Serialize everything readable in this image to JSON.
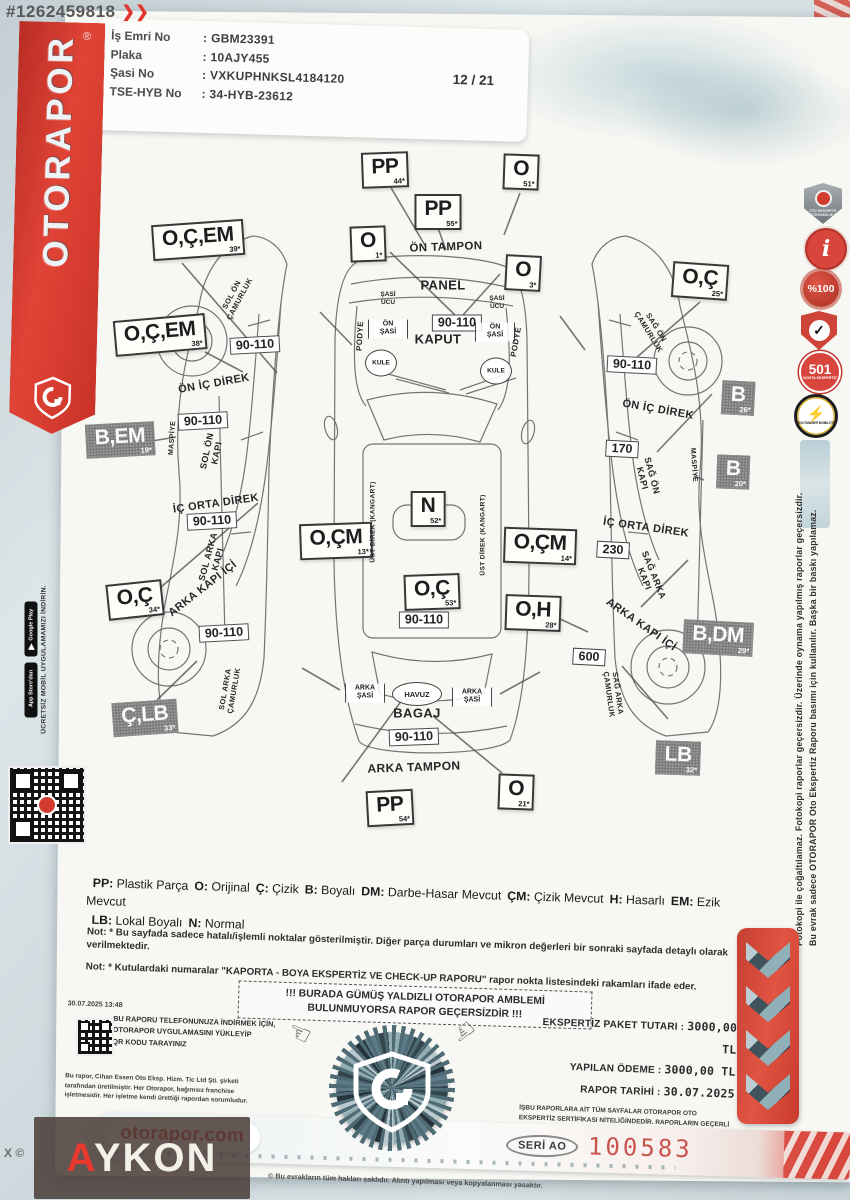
{
  "watermark": {
    "listing_id": "#1262459818",
    "chevrons": "❯❯",
    "brand_a": "A",
    "brand_rest": "YKON",
    "corner": "X ©"
  },
  "ribbon": {
    "brand": "OTORAPOR",
    "reg": "®"
  },
  "header": {
    "fields": [
      {
        "label": "İş Emri No",
        "value": "GBM23391"
      },
      {
        "label": "Plaka",
        "value": "10AJY455"
      },
      {
        "label": "Şasi No",
        "value": "VXKUPHNKSL4184120"
      },
      {
        "label": "TSE-HYB No",
        "value": "34-HYB-23612"
      }
    ],
    "page": "12 / 21"
  },
  "badges": [
    {
      "name": "mucit-shield-badge",
      "label": "OTO EKSPERTİZ SEKTÖRÜNÜN MUCİDİ"
    },
    {
      "name": "info-badge",
      "label": "i"
    },
    {
      "name": "percent-100-badge",
      "label": "%100"
    },
    {
      "name": "check-shield-badge",
      "label": "✓"
    },
    {
      "name": "501-nokta-badge",
      "label": "501",
      "sub": "NOKTA EKSPERTİZ"
    },
    {
      "name": "voltmaner-badge",
      "label": "⚡",
      "sub": "VOLTMANER MOBILITY"
    }
  ],
  "side_disclaimer": {
    "line1": "Bu evrak sadece OTORAPOR Oto Ekspertiz Raporu basımı için kullanılır. Başka bir baskı yapılamaz.",
    "line2": "Fotokopi ile çoğaltılamaz. Fotokopi raporlar geçersizdir. Üzerinde oynama yapılmış raporlar geçersizdir."
  },
  "diagram": {
    "markers": [
      {
        "k": "light",
        "t": "O,Ç,EM",
        "n": "39*",
        "x": 198,
        "y": 240,
        "rot": -4
      },
      {
        "k": "light",
        "t": "O,Ç,EM",
        "n": "38*",
        "x": 160,
        "y": 335,
        "rot": -5
      },
      {
        "k": "light",
        "t": "O,Ç",
        "n": "34*",
        "x": 135,
        "y": 600,
        "rot": -6
      },
      {
        "k": "light",
        "t": "PP",
        "n": "44*",
        "x": 385,
        "y": 170,
        "rot": -2
      },
      {
        "k": "light",
        "t": "PP",
        "n": "55*",
        "x": 438,
        "y": 212,
        "rot": 0
      },
      {
        "k": "light",
        "t": "O",
        "n": "51*",
        "x": 521,
        "y": 172,
        "rot": 2
      },
      {
        "k": "light",
        "t": "O",
        "n": "1*",
        "x": 368,
        "y": 244,
        "rot": -2
      },
      {
        "k": "light",
        "t": "O",
        "n": "3*",
        "x": 523,
        "y": 273,
        "rot": 3
      },
      {
        "k": "light",
        "t": "O,Ç",
        "n": "25*",
        "x": 700,
        "y": 281,
        "rot": 4
      },
      {
        "k": "light",
        "t": "N",
        "n": "52*",
        "x": 428,
        "y": 509,
        "rot": 0
      },
      {
        "k": "light",
        "t": "O,ÇM",
        "n": "13*",
        "x": 336,
        "y": 541,
        "rot": -2
      },
      {
        "k": "light",
        "t": "O,ÇM",
        "n": "14*",
        "x": 540,
        "y": 546,
        "rot": 2
      },
      {
        "k": "light",
        "t": "O,Ç",
        "n": "53*",
        "x": 432,
        "y": 592,
        "rot": -2
      },
      {
        "k": "light",
        "t": "O,H",
        "n": "28*",
        "x": 533,
        "y": 613,
        "rot": 2
      },
      {
        "k": "light",
        "t": "PP",
        "n": "54*",
        "x": 390,
        "y": 808,
        "rot": -3
      },
      {
        "k": "light",
        "t": "O",
        "n": "21*",
        "x": 516,
        "y": 792,
        "rot": 2
      },
      {
        "k": "dark",
        "t": "B,EM",
        "n": "19*",
        "x": 120,
        "y": 440,
        "rot": -3
      },
      {
        "k": "dark",
        "t": "Ç,LB",
        "n": "33*",
        "x": 145,
        "y": 718,
        "rot": -4
      },
      {
        "k": "dark",
        "t": "B",
        "n": "26*",
        "x": 738,
        "y": 398,
        "rot": 3
      },
      {
        "k": "dark",
        "t": "B",
        "n": "20*",
        "x": 733,
        "y": 472,
        "rot": 2
      },
      {
        "k": "dark",
        "t": "B,DM",
        "n": "29*",
        "x": 718,
        "y": 638,
        "rot": 3
      },
      {
        "k": "dark",
        "t": "LB",
        "n": "32*",
        "x": 678,
        "y": 758,
        "rot": 2
      },
      {
        "k": "val",
        "t": "90-110",
        "x": 255,
        "y": 345,
        "rot": -3
      },
      {
        "k": "val",
        "t": "90-110",
        "x": 203,
        "y": 421,
        "rot": -3
      },
      {
        "k": "val",
        "t": "90-110",
        "x": 212,
        "y": 521,
        "rot": -3
      },
      {
        "k": "val",
        "t": "90-110",
        "x": 224,
        "y": 633,
        "rot": -3
      },
      {
        "k": "val",
        "t": "90-110",
        "x": 457,
        "y": 323,
        "rot": 0
      },
      {
        "k": "val",
        "t": "90-110",
        "x": 424,
        "y": 620,
        "rot": 0
      },
      {
        "k": "val",
        "t": "90-110",
        "x": 414,
        "y": 737,
        "rot": -2
      },
      {
        "k": "val",
        "t": "90-110",
        "x": 632,
        "y": 365,
        "rot": 3
      },
      {
        "k": "val",
        "t": "170",
        "x": 622,
        "y": 449,
        "rot": 3
      },
      {
        "k": "val",
        "t": "230",
        "x": 613,
        "y": 550,
        "rot": 3
      },
      {
        "k": "val",
        "t": "600",
        "x": 589,
        "y": 657,
        "rot": 3
      },
      {
        "k": "sbox",
        "t": "ÖN|ŞASİ",
        "x": 388,
        "y": 329
      },
      {
        "k": "sbox",
        "t": "ÖN|ŞASİ",
        "x": 495,
        "y": 332
      },
      {
        "k": "sbox",
        "t": "ARKA|ŞASİ",
        "x": 365,
        "y": 693
      },
      {
        "k": "sbox",
        "t": "ARKA|ŞASİ",
        "x": 472,
        "y": 697
      },
      {
        "k": "txt",
        "t": "ŞASİ|UCU",
        "x": 388,
        "y": 299
      },
      {
        "k": "txt",
        "t": "ŞASİ|UCU",
        "x": 497,
        "y": 303
      },
      {
        "k": "circ",
        "t": "KULE",
        "x": 381,
        "y": 363
      },
      {
        "k": "circ",
        "t": "KULE",
        "x": 496,
        "y": 371
      },
      {
        "k": "ell",
        "t": "HAVUZ",
        "x": 417,
        "y": 694
      },
      {
        "k": "part",
        "t": "ÖN TAMPON",
        "x": 446,
        "y": 248,
        "rot": -2,
        "fs": 11.5
      },
      {
        "k": "part",
        "t": "PANEL",
        "x": 443,
        "y": 286,
        "rot": 0,
        "fs": 13
      },
      {
        "k": "part",
        "t": "KAPUT",
        "x": 438,
        "y": 340,
        "rot": 0,
        "fs": 13
      },
      {
        "k": "part",
        "t": "BAGAJ",
        "x": 417,
        "y": 714,
        "rot": 0,
        "fs": 13
      },
      {
        "k": "part",
        "t": "ARKA TAMPON",
        "x": 414,
        "y": 768,
        "rot": -2,
        "fs": 12
      },
      {
        "k": "part",
        "t": "ÖN İÇ DİREK",
        "x": 214,
        "y": 384,
        "rot": -10,
        "fs": 11
      },
      {
        "k": "part",
        "t": "İÇ ORTA DİREK",
        "x": 216,
        "y": 504,
        "rot": -8,
        "fs": 11
      },
      {
        "k": "part",
        "t": "ARKA KAPI İÇİ",
        "x": 203,
        "y": 589,
        "rot": -38,
        "fs": 11
      },
      {
        "k": "part",
        "t": "SOL ÖN|KAPI",
        "x": 212,
        "y": 452,
        "rot": -78,
        "fs": 9
      },
      {
        "k": "part",
        "t": "SOL ARKA|KAPI",
        "x": 213,
        "y": 558,
        "rot": -75,
        "fs": 9
      },
      {
        "k": "part",
        "t": "SOL ÖN|ÇAMURLUK",
        "x": 236,
        "y": 297,
        "rot": -62,
        "fs": 7.5
      },
      {
        "k": "part",
        "t": "SOL ARKA|ÇAMURLUK",
        "x": 230,
        "y": 690,
        "rot": -80,
        "fs": 7.5
      },
      {
        "k": "part",
        "t": "MASPİYE",
        "x": 173,
        "y": 438,
        "rot": -86,
        "fs": 7
      },
      {
        "k": "part",
        "t": "PODYE",
        "x": 360,
        "y": 336,
        "rot": -87,
        "fs": 8
      },
      {
        "k": "part",
        "t": "PODYE",
        "x": 516,
        "y": 342,
        "rot": -80,
        "fs": 8
      },
      {
        "k": "part",
        "t": "ÜST DİREK (KANGART)",
        "x": 373,
        "y": 522,
        "rot": -90,
        "fs": 6.5
      },
      {
        "k": "part",
        "t": "ÜST DİREK (KANGART)",
        "x": 483,
        "y": 535,
        "rot": -90,
        "fs": 6.5
      },
      {
        "k": "part",
        "t": "SAĞ ÖN|ÇAMURLUK",
        "x": 652,
        "y": 330,
        "rot": 58,
        "fs": 7.5
      },
      {
        "k": "part",
        "t": "ÖN İÇ DİREK",
        "x": 658,
        "y": 410,
        "rot": 10,
        "fs": 11
      },
      {
        "k": "part",
        "t": "SAĞ ÖN|KAPI",
        "x": 647,
        "y": 477,
        "rot": 75,
        "fs": 9
      },
      {
        "k": "part",
        "t": "MASPİYE",
        "x": 693,
        "y": 465,
        "rot": 86,
        "fs": 7
      },
      {
        "k": "part",
        "t": "İÇ ORTA DİREK",
        "x": 646,
        "y": 528,
        "rot": 8,
        "fs": 11
      },
      {
        "k": "part",
        "t": "SAĞ ARKA|KAPI",
        "x": 649,
        "y": 577,
        "rot": 68,
        "fs": 9
      },
      {
        "k": "part",
        "t": "ARKA KAPI İÇİ",
        "x": 641,
        "y": 625,
        "rot": 35,
        "fs": 11
      },
      {
        "k": "part",
        "t": "SAĞ ARKA|ÇAMURLUK",
        "x": 613,
        "y": 694,
        "rot": 82,
        "fs": 7.5
      }
    ]
  },
  "legend": {
    "items": [
      {
        "k": "PP",
        "v": "Plastik Parça"
      },
      {
        "k": "O",
        "v": "Orijinal"
      },
      {
        "k": "Ç",
        "v": "Çizik"
      },
      {
        "k": "B",
        "v": "Boyalı"
      },
      {
        "k": "DM",
        "v": "Darbe-Hasar Mevcut"
      },
      {
        "k": "ÇM",
        "v": "Çizik Mevcut"
      },
      {
        "k": "H",
        "v": "Hasarlı"
      },
      {
        "k": "EM",
        "v": "Ezik Mevcut"
      },
      {
        "k": "LB",
        "v": "Lokal Boyalı"
      },
      {
        "k": "N",
        "v": "Normal"
      }
    ]
  },
  "notes": [
    "Not: * Bu sayfada sadece hatalı/işlemli noktalar gösterilmiştir. Diğer parça durumları ve mikron değerleri bir sonraki sayfada detaylı olarak verilmektedir.",
    "Not: * Kutulardaki numaralar \"KAPORTA - BOYA EKSPERTİZ VE CHECK-UP RAPORU\" rapor nokta listesindeki rakamları ifade eder."
  ],
  "warning": {
    "line1": "!!! BURADA GÜMÜŞ YALDIZLI OTORAPOR AMBLEMİ",
    "line2": "BULUNMUYORSA RAPOR GEÇERSİZDİR !!!"
  },
  "app_promo": {
    "caption": "ÜCRETSİZ MOBİL UYGULAMAMIZI İNDİRİN.",
    "stores": [
      {
        "name": "app-store-badge",
        "label": "App Store'dan"
      },
      {
        "name": "google-play-badge",
        "label": "Google Play"
      }
    ]
  },
  "download": {
    "timestamp": "30.07.2025 13:48",
    "lines": [
      "BU RAPORU TELEFONUNUZA İNDİRMEK İÇİN,",
      "OTORAPOR UYGULAMASINI YÜKLEYİP",
      "QR KODU TARAYINIZ"
    ],
    "producer": "Bu rapor, Cihan Essen Oto Eksp. Hizm. Tic Ltd Şti. şirketi tarafından üretilmiştir. Her Otorapor, bağımsız franchise işletmesidir. Her işletme kendi ürettiği rapordan sorumludur."
  },
  "payment": {
    "rows": [
      {
        "label": "EKSPERTİZ PAKET TUTARI",
        "value": "3000,00 TL"
      },
      {
        "label": "YAPILAN ÖDEME",
        "value": "3000,00 TL"
      },
      {
        "label": "RAPOR TARİHİ",
        "value": "30.07.2025"
      }
    ],
    "hologram_note": "İŞBU RAPORLARA AİT TÜM SAYFALAR OTORAPOR OTO EKSPERTİZ SERTİFİKASI NİTELİĞİNDEDİR. RAPORLARIN GEÇERLİ OLABİLMESİ İÇİN HER SAYFADA GÜMÜŞ HOLOGRAM BULUNMAK ZORUNDADIR. GÜMÜŞ HOLOGRAM BULUNMAYAN, ANTETLİ KAĞIDA BASILMAMIŞ RAPORLAR GEÇERSİZDİR."
  },
  "footer": {
    "site": "otorapor.com",
    "serial_label": "SERİ AO",
    "serial_number": "100583",
    "copyright": "© Bu evrakların tüm hakları saklıdır. Alıntı yapılması veya kopyalanması yasaktır."
  },
  "colors": {
    "brand_red": "#d6352c",
    "marker_dark": "#7a7a7a",
    "serial_red": "#c9544e"
  }
}
